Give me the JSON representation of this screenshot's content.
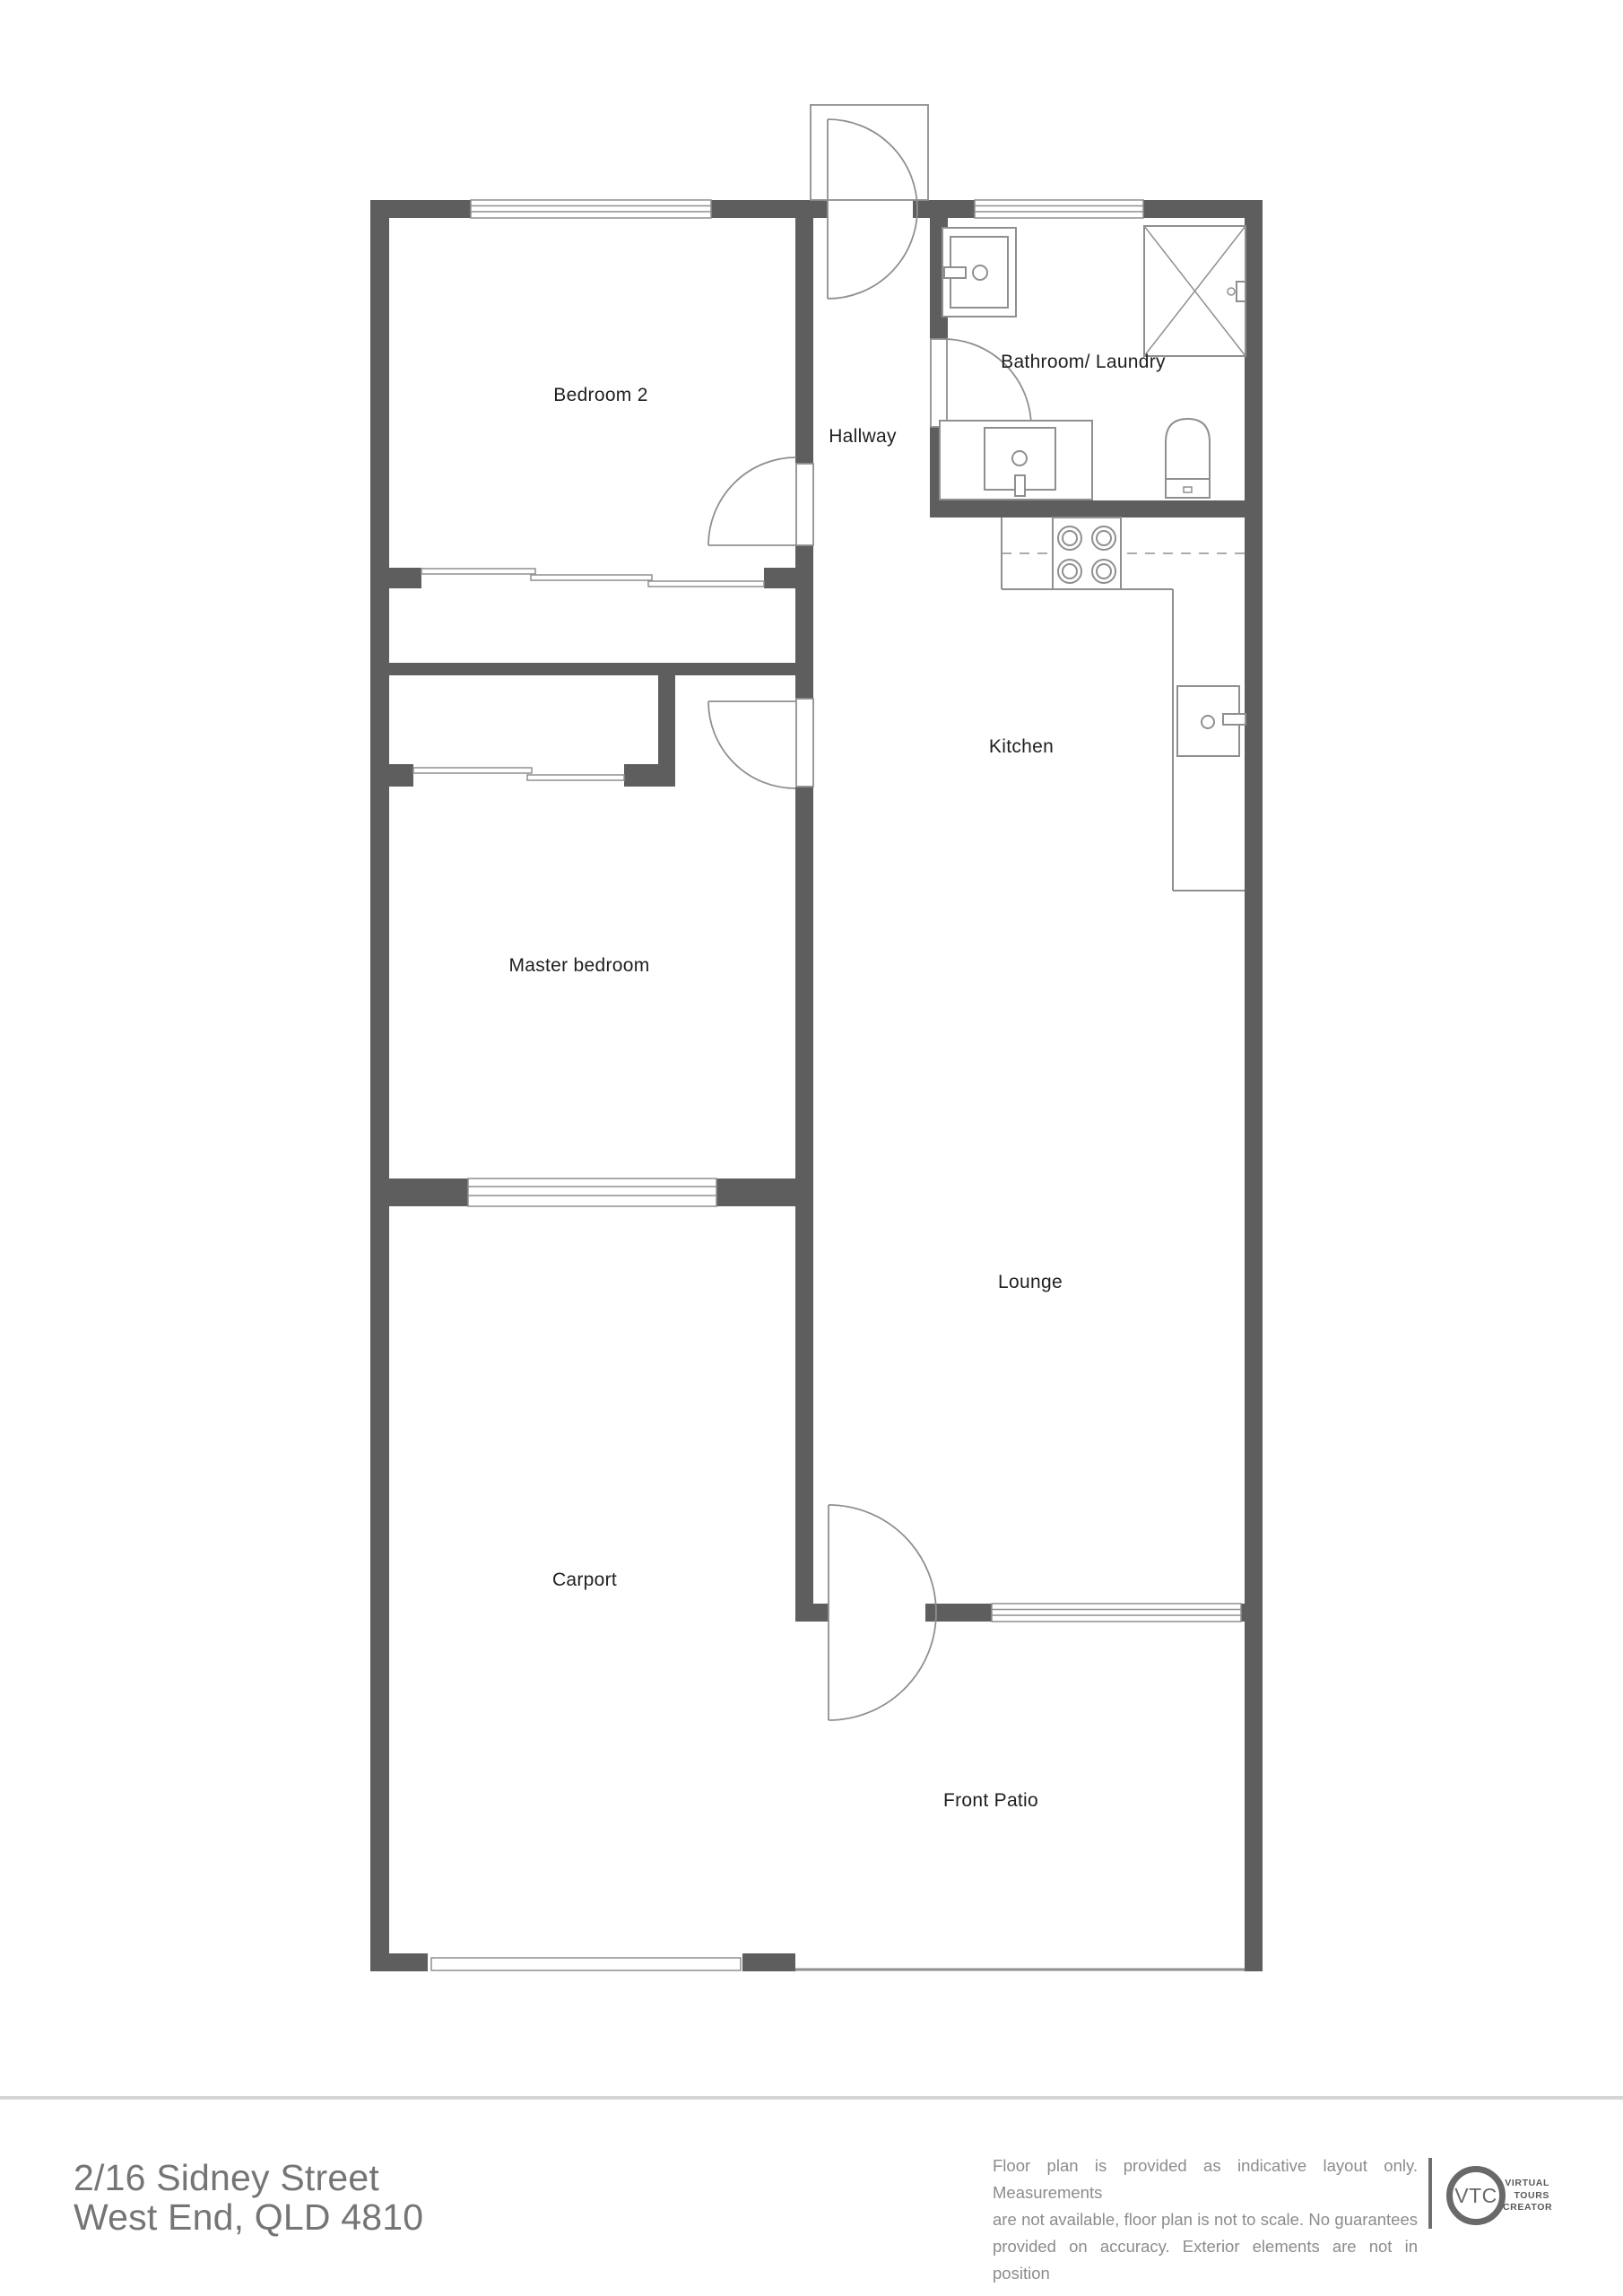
{
  "rooms": {
    "bedroom2": "Bedroom 2",
    "hallway": "Hallway",
    "bathroom_laundry": "Bathroom/ Laundry",
    "kitchen": "Kitchen",
    "master_bedroom": "Master bedroom",
    "lounge": "Lounge",
    "carport": "Carport",
    "front_patio": "Front Patio"
  },
  "fixtures": {
    "icons": [
      "vanity-sink-icon",
      "shower-icon",
      "toilet-icon",
      "washing-machine-icon",
      "cooktop-icon",
      "kitchen-sink-icon",
      "door-swing-icon",
      "sliding-door-icon",
      "window-icon"
    ]
  },
  "footer": {
    "address_line1": "2/16 Sidney Street",
    "address_line2": "West End, QLD 4810",
    "disclaimer_line1": "Floor plan is provided as indicative layout only. Measurements",
    "disclaimer_line2": "are not available, floor plan is not to scale. No guarantees",
    "disclaimer_line3": "provided on accuracy. Exterior elements are not in position",
    "logo": {
      "monogram": "VTC",
      "name_line1": "VIRTUAL",
      "name_line2": "TOURS",
      "name_line3": "CREATOR"
    }
  },
  "colors": {
    "wall": "#5e5e5e",
    "thin_line": "#8f8f8f",
    "label_text": "#1f1f1f",
    "address_text": "#757575",
    "disclaimer_text": "#8c8c8c",
    "separator": "#d5d5d5",
    "logo": "#696969",
    "background": "#ffffff"
  }
}
